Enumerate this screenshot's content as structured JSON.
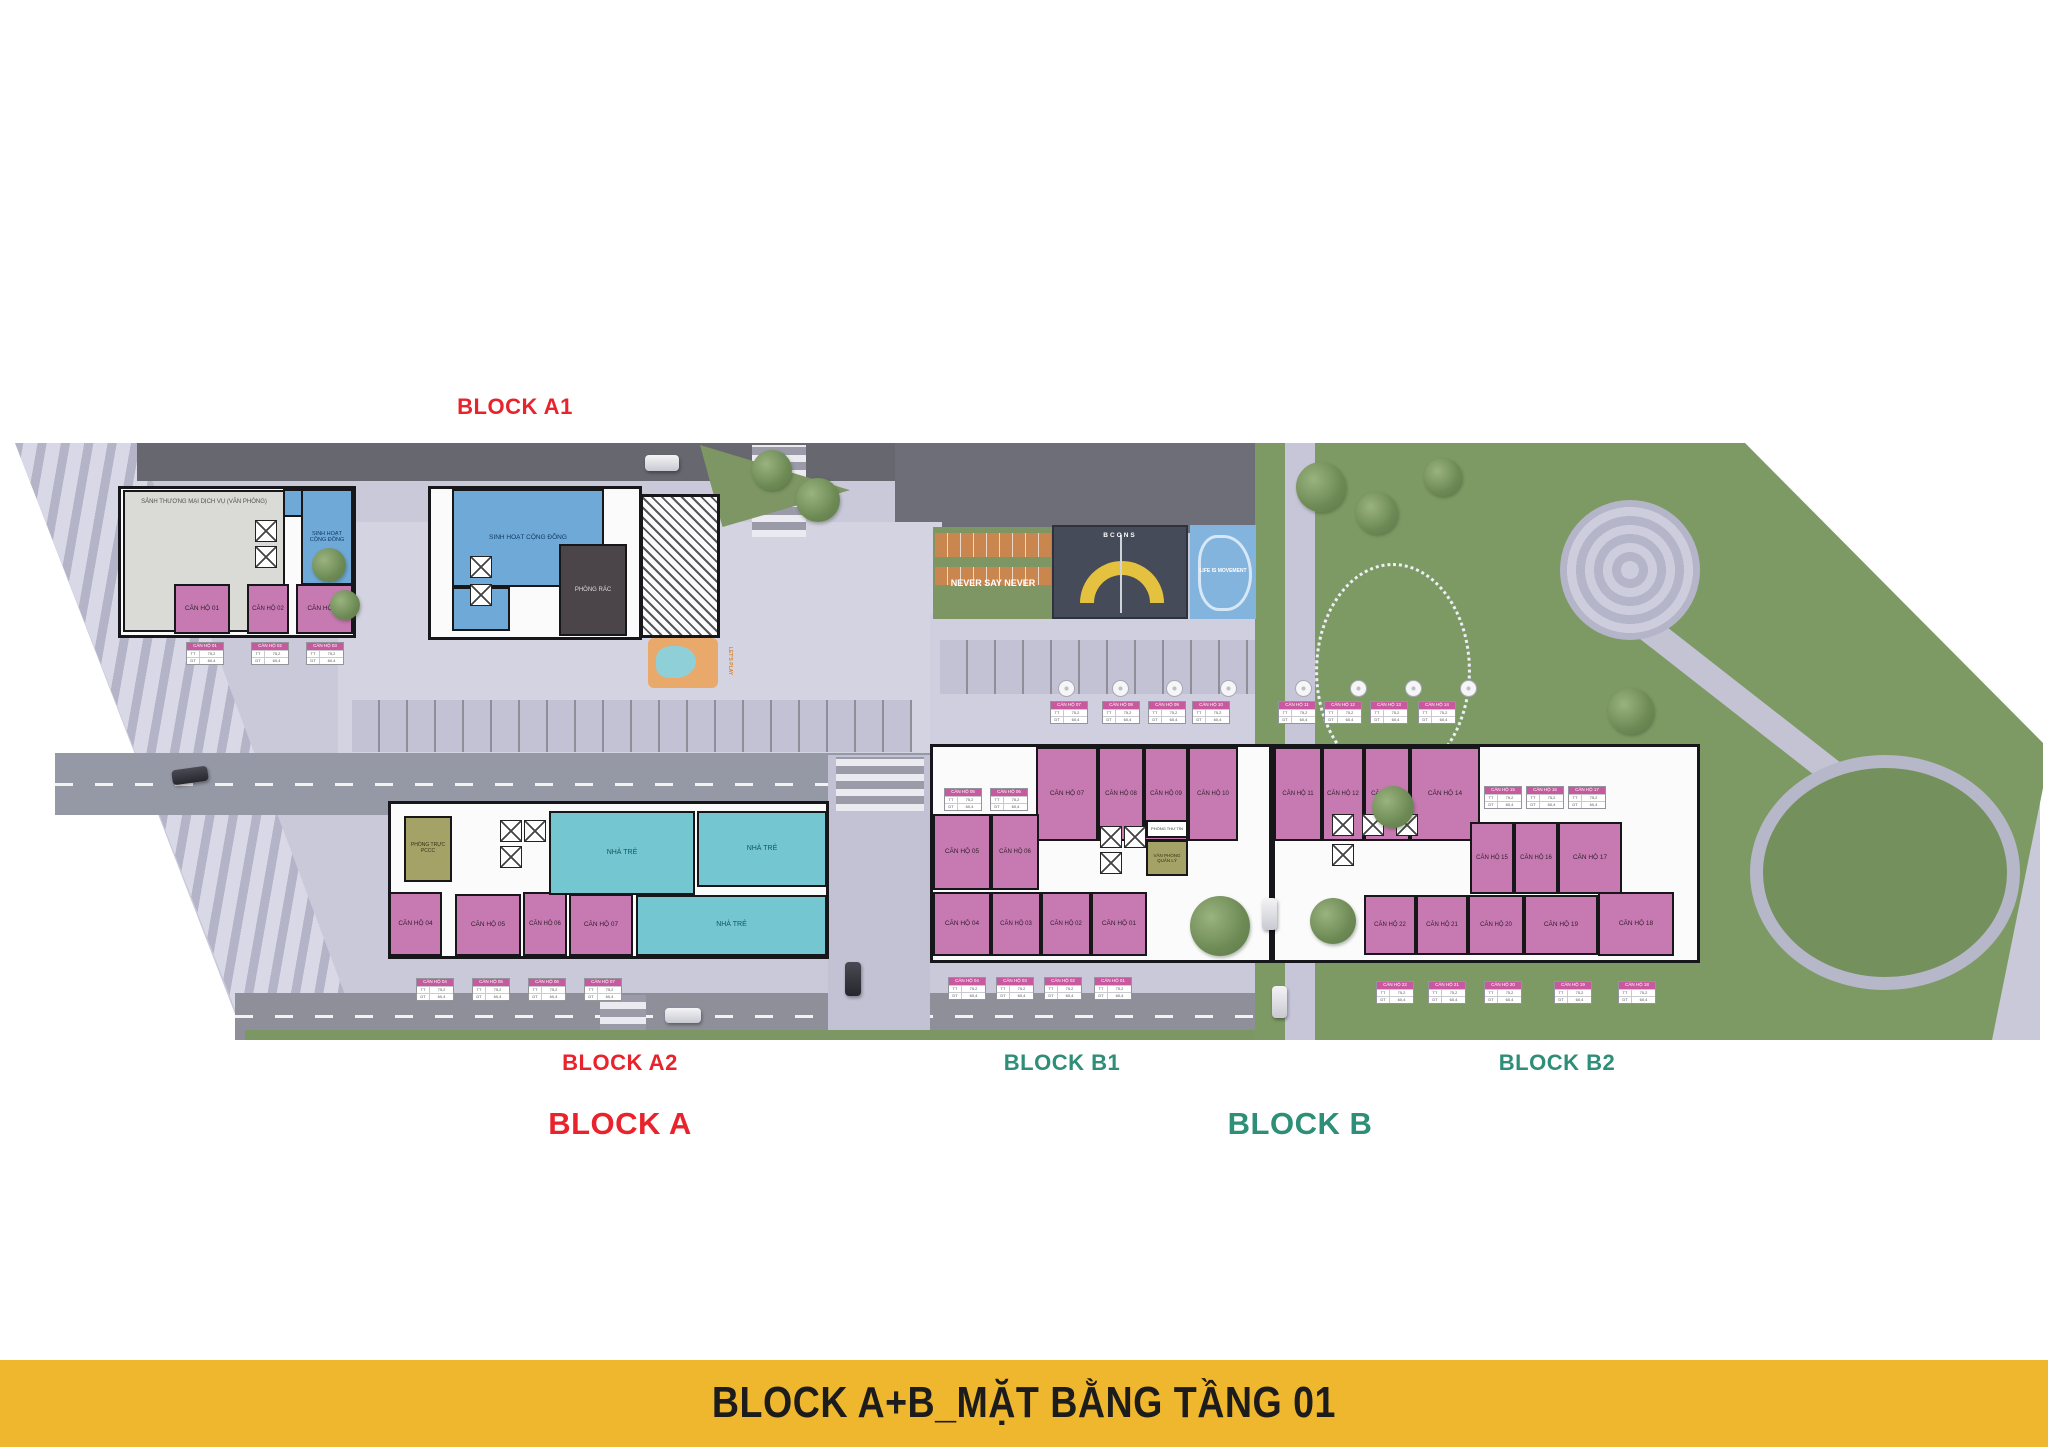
{
  "banner": {
    "text": "BLOCK A+B_MẶT BẰNG TẦNG 01",
    "bg": "#efb72e",
    "fg": "#1c1c1c"
  },
  "labels": {
    "block_a1": {
      "text": "BLOCK A1",
      "color": "#e8232b"
    },
    "block_a2": {
      "text": "BLOCK A2",
      "color": "#e8232b"
    },
    "block_a": {
      "text": "BLOCK A",
      "color": "#e8232b"
    },
    "block_b1": {
      "text": "BLOCK B1",
      "color": "#2e8e77"
    },
    "block_b2": {
      "text": "BLOCK B2",
      "color": "#2e8e77"
    },
    "block_b": {
      "text": "BLOCK B",
      "color": "#2e8e77"
    }
  },
  "amenities": {
    "fitness": "NEVER SAY NEVER",
    "court_brand": "BCONS",
    "skate": "LIFE IS MOVEMENT",
    "playground": "LET'S PLAY"
  },
  "plan": {
    "rooms": [
      {
        "name": "room-commercial-lobby",
        "label": "SẢNH THƯƠNG MẠI DỊCH VỤ (VĂN PHÒNG)",
        "cls": "gray top",
        "x": 123,
        "y": 490,
        "w": 162,
        "h": 142,
        "fs": 6
      },
      {
        "name": "room-community",
        "label": "SINH HOẠT CỘNG ĐỒNG",
        "cls": "blue",
        "x": 301,
        "y": 489,
        "w": 52,
        "h": 96,
        "fs": 5.5
      },
      {
        "name": "room-community-annex",
        "label": "",
        "cls": "blue",
        "x": 283,
        "y": 489,
        "w": 20,
        "h": 28,
        "fs": 5
      },
      {
        "name": "unit-a1-01",
        "label": "CĂN HỘ 01",
        "cls": "pink",
        "x": 174,
        "y": 584,
        "w": 56,
        "h": 50,
        "fs": 6.5
      },
      {
        "name": "unit-a1-02",
        "label": "CĂN HỘ 02",
        "cls": "pink",
        "x": 247,
        "y": 584,
        "w": 42,
        "h": 50,
        "fs": 6
      },
      {
        "name": "unit-a1-03",
        "label": "CĂN HỘ 03",
        "cls": "pink",
        "x": 296,
        "y": 584,
        "w": 57,
        "h": 50,
        "fs": 6.5
      },
      {
        "name": "room-community-2",
        "label": "SINH HOẠT CỘNG ĐỒNG",
        "cls": "blue",
        "x": 452,
        "y": 489,
        "w": 152,
        "h": 98,
        "fs": 6.5
      },
      {
        "name": "room-community-2-annex",
        "label": "",
        "cls": "blue",
        "x": 452,
        "y": 587,
        "w": 58,
        "h": 44,
        "fs": 5
      },
      {
        "name": "room-trash",
        "label": "PHÒNG RÁC",
        "cls": "dark",
        "x": 559,
        "y": 544,
        "w": 68,
        "h": 92,
        "fs": 6
      },
      {
        "name": "room-fire-duty",
        "label": "PHÒNG TRỰC PCCC",
        "cls": "olive",
        "x": 404,
        "y": 816,
        "w": 48,
        "h": 66,
        "fs": 5
      },
      {
        "name": "unit-a2-04",
        "label": "CĂN HỘ 04",
        "cls": "pink",
        "x": 389,
        "y": 892,
        "w": 53,
        "h": 64,
        "fs": 6.5
      },
      {
        "name": "unit-a2-05",
        "label": "CĂN HỘ 05",
        "cls": "pink",
        "x": 455,
        "y": 894,
        "w": 66,
        "h": 62,
        "fs": 6.5
      },
      {
        "name": "unit-a2-06",
        "label": "CĂN HỘ 06",
        "cls": "pink",
        "x": 523,
        "y": 892,
        "w": 44,
        "h": 64,
        "fs": 6
      },
      {
        "name": "unit-a2-07",
        "label": "CĂN HỘ 07",
        "cls": "pink",
        "x": 569,
        "y": 894,
        "w": 64,
        "h": 62,
        "fs": 6.5
      },
      {
        "name": "room-kindergarten-1",
        "label": "NHÀ TRẺ",
        "cls": "cyan",
        "x": 549,
        "y": 811,
        "w": 146,
        "h": 84,
        "fs": 7
      },
      {
        "name": "room-kindergarten-2",
        "label": "NHÀ TRẺ",
        "cls": "cyan",
        "x": 697,
        "y": 811,
        "w": 130,
        "h": 76,
        "fs": 7
      },
      {
        "name": "room-kindergarten-3",
        "label": "NHÀ TRẺ",
        "cls": "cyan",
        "x": 636,
        "y": 895,
        "w": 191,
        "h": 61,
        "fs": 7
      },
      {
        "name": "unit-b1-07",
        "label": "CĂN HỘ 07",
        "cls": "pink",
        "x": 1036,
        "y": 747,
        "w": 62,
        "h": 94,
        "fs": 6.5
      },
      {
        "name": "unit-b1-08",
        "label": "CĂN HỘ 08",
        "cls": "pink",
        "x": 1098,
        "y": 747,
        "w": 46,
        "h": 94,
        "fs": 6
      },
      {
        "name": "unit-b1-09",
        "label": "CĂN HỘ 09",
        "cls": "pink",
        "x": 1144,
        "y": 747,
        "w": 44,
        "h": 94,
        "fs": 6
      },
      {
        "name": "unit-b1-10",
        "label": "CĂN HỘ 10",
        "cls": "pink",
        "x": 1188,
        "y": 747,
        "w": 50,
        "h": 94,
        "fs": 6
      },
      {
        "name": "unit-b1-05",
        "label": "CĂN HỘ 05",
        "cls": "pink",
        "x": 933,
        "y": 814,
        "w": 58,
        "h": 76,
        "fs": 6.5
      },
      {
        "name": "unit-b1-06",
        "label": "CĂN HỘ 06",
        "cls": "pink",
        "x": 991,
        "y": 814,
        "w": 48,
        "h": 76,
        "fs": 6
      },
      {
        "name": "unit-b1-04",
        "label": "CĂN HỘ 04",
        "cls": "pink",
        "x": 933,
        "y": 892,
        "w": 58,
        "h": 64,
        "fs": 6.5
      },
      {
        "name": "unit-b1-03",
        "label": "CĂN HỘ 03",
        "cls": "pink",
        "x": 991,
        "y": 892,
        "w": 50,
        "h": 64,
        "fs": 6
      },
      {
        "name": "unit-b1-02",
        "label": "CĂN HỘ 02",
        "cls": "pink",
        "x": 1041,
        "y": 892,
        "w": 50,
        "h": 64,
        "fs": 6
      },
      {
        "name": "unit-b1-01",
        "label": "CĂN HỘ 01",
        "cls": "pink",
        "x": 1091,
        "y": 892,
        "w": 56,
        "h": 64,
        "fs": 6.5
      },
      {
        "name": "room-mail",
        "label": "PHÒNG THƯ TÍN",
        "cls": "white",
        "x": 1146,
        "y": 820,
        "w": 42,
        "h": 18,
        "fs": 4
      },
      {
        "name": "room-management-office",
        "label": "VĂN PHÒNG QUẢN LÝ",
        "cls": "olive",
        "x": 1146,
        "y": 840,
        "w": 42,
        "h": 36,
        "fs": 4.5
      },
      {
        "name": "unit-b2-11",
        "label": "CĂN HỘ 11",
        "cls": "pink",
        "x": 1274,
        "y": 747,
        "w": 48,
        "h": 94,
        "fs": 6
      },
      {
        "name": "unit-b2-12",
        "label": "CĂN HỘ 12",
        "cls": "pink",
        "x": 1322,
        "y": 747,
        "w": 42,
        "h": 94,
        "fs": 6
      },
      {
        "name": "unit-b2-13",
        "label": "CĂN HỘ 13",
        "cls": "pink",
        "x": 1364,
        "y": 747,
        "w": 46,
        "h": 94,
        "fs": 6
      },
      {
        "name": "unit-b2-14",
        "label": "CĂN HỘ 14",
        "cls": "pink",
        "x": 1410,
        "y": 747,
        "w": 70,
        "h": 94,
        "fs": 6.5
      },
      {
        "name": "unit-b2-15",
        "label": "CĂN HỘ 15",
        "cls": "pink",
        "x": 1470,
        "y": 822,
        "w": 44,
        "h": 72,
        "fs": 6
      },
      {
        "name": "unit-b2-16",
        "label": "CĂN HỘ 16",
        "cls": "pink",
        "x": 1514,
        "y": 822,
        "w": 44,
        "h": 72,
        "fs": 6
      },
      {
        "name": "unit-b2-17",
        "label": "CĂN HỘ 17",
        "cls": "pink",
        "x": 1558,
        "y": 822,
        "w": 64,
        "h": 72,
        "fs": 6.5
      },
      {
        "name": "unit-b2-22",
        "label": "CĂN HỘ 22",
        "cls": "pink",
        "x": 1364,
        "y": 895,
        "w": 52,
        "h": 60,
        "fs": 6
      },
      {
        "name": "unit-b2-21",
        "label": "CĂN HỘ 21",
        "cls": "pink",
        "x": 1416,
        "y": 895,
        "w": 52,
        "h": 60,
        "fs": 6
      },
      {
        "name": "unit-b2-20",
        "label": "CĂN HỘ 20",
        "cls": "pink",
        "x": 1468,
        "y": 895,
        "w": 56,
        "h": 60,
        "fs": 6
      },
      {
        "name": "unit-b2-19",
        "label": "CĂN HỘ 19",
        "cls": "pink",
        "x": 1524,
        "y": 895,
        "w": 74,
        "h": 60,
        "fs": 6.5
      },
      {
        "name": "unit-b2-18",
        "label": "CĂN HỘ 18",
        "cls": "pink",
        "x": 1598,
        "y": 892,
        "w": 76,
        "h": 64,
        "fs": 6.5
      }
    ],
    "tables": [
      {
        "label": "CĂN HỘ 01",
        "x": 186,
        "y": 642
      },
      {
        "label": "CĂN HỘ 02",
        "x": 251,
        "y": 642
      },
      {
        "label": "CĂN HỘ 03",
        "x": 306,
        "y": 642
      },
      {
        "label": "CĂN HỘ 04",
        "x": 416,
        "y": 978
      },
      {
        "label": "CĂN HỘ 05",
        "x": 472,
        "y": 978
      },
      {
        "label": "CĂN HỘ 06",
        "x": 528,
        "y": 978
      },
      {
        "label": "CĂN HỘ 07",
        "x": 584,
        "y": 978
      },
      {
        "label": "CĂN HỘ 07",
        "x": 1050,
        "y": 701
      },
      {
        "label": "CĂN HỘ 08",
        "x": 1102,
        "y": 701
      },
      {
        "label": "CĂN HỘ 09",
        "x": 1148,
        "y": 701
      },
      {
        "label": "CĂN HỘ 10",
        "x": 1192,
        "y": 701
      },
      {
        "label": "CĂN HỘ 11",
        "x": 1278,
        "y": 701
      },
      {
        "label": "CĂN HỘ 12",
        "x": 1324,
        "y": 701
      },
      {
        "label": "CĂN HỘ 13",
        "x": 1370,
        "y": 701
      },
      {
        "label": "CĂN HỘ 14",
        "x": 1418,
        "y": 701
      },
      {
        "label": "CĂN HỘ 05",
        "x": 944,
        "y": 788
      },
      {
        "label": "CĂN HỘ 06",
        "x": 990,
        "y": 788
      },
      {
        "label": "CĂN HỘ 15",
        "x": 1484,
        "y": 786
      },
      {
        "label": "CĂN HỘ 16",
        "x": 1526,
        "y": 786
      },
      {
        "label": "CĂN HỘ 17",
        "x": 1568,
        "y": 786
      },
      {
        "label": "CĂN HỘ 04",
        "x": 948,
        "y": 977
      },
      {
        "label": "CĂN HỘ 03",
        "x": 996,
        "y": 977
      },
      {
        "label": "CĂN HỘ 02",
        "x": 1044,
        "y": 977
      },
      {
        "label": "CĂN HỘ 01",
        "x": 1094,
        "y": 977
      },
      {
        "label": "CĂN HỘ 22",
        "x": 1376,
        "y": 981
      },
      {
        "label": "CĂN HỘ 21",
        "x": 1428,
        "y": 981
      },
      {
        "label": "CĂN HỘ 20",
        "x": 1484,
        "y": 981
      },
      {
        "label": "CĂN HỘ 19",
        "x": 1554,
        "y": 981
      },
      {
        "label": "CĂN HỘ 18",
        "x": 1618,
        "y": 981
      }
    ],
    "table_rows": [
      [
        "TT",
        "75,2"
      ],
      [
        "DT",
        "60,4"
      ]
    ],
    "xboxes": [
      [
        255,
        520
      ],
      [
        255,
        546
      ],
      [
        470,
        556
      ],
      [
        470,
        584
      ],
      [
        500,
        820
      ],
      [
        524,
        820
      ],
      [
        500,
        846
      ],
      [
        1100,
        826
      ],
      [
        1124,
        826
      ],
      [
        1100,
        852
      ],
      [
        1332,
        814
      ],
      [
        1362,
        814
      ],
      [
        1396,
        814
      ],
      [
        1332,
        844
      ]
    ]
  }
}
